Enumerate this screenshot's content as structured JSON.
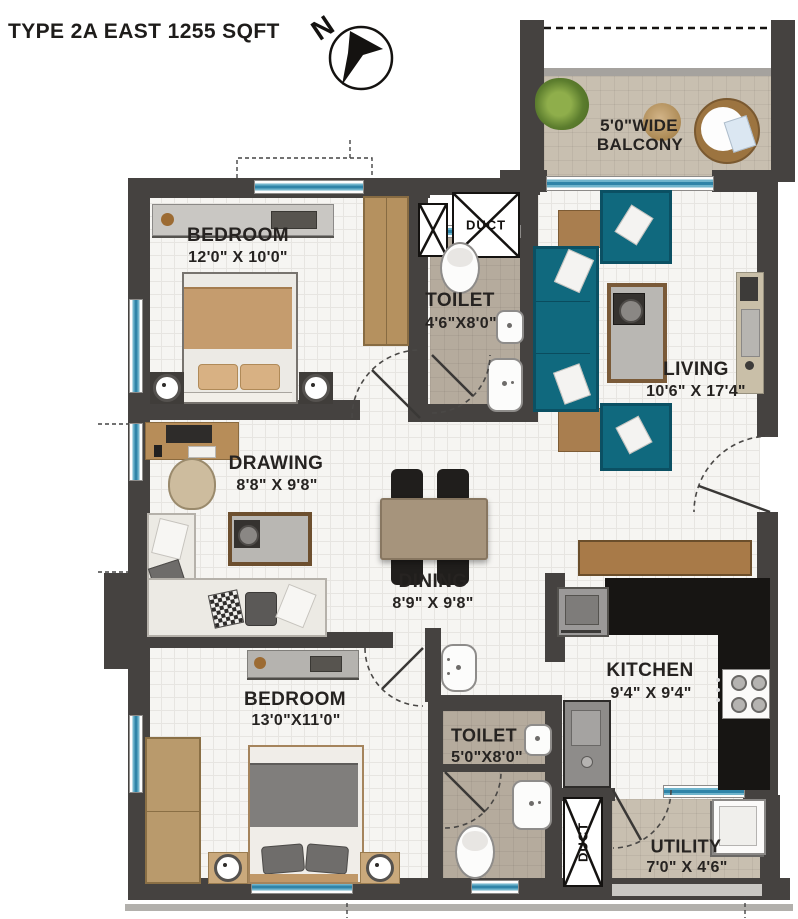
{
  "title": "TYPE 2A EAST 1255 SQFT",
  "compass": {
    "north_label": "N"
  },
  "rooms": {
    "balcony": {
      "label_line1": "5'0\"WIDE",
      "label_line2": "BALCONY"
    },
    "bedroom1": {
      "label": "BEDROOM",
      "dims": "12'0\" X 10'0\""
    },
    "toilet1": {
      "label": "TOILET",
      "dims": "4'6\"X8'0\""
    },
    "living": {
      "label": "LIVING",
      "dims": "10'6\" X 17'4\""
    },
    "drawing": {
      "label": "DRAWING",
      "dims": "8'8\" X 9'8\""
    },
    "dining": {
      "label": "DINING",
      "dims": "8'9\" X 9'8\""
    },
    "bedroom2": {
      "label": "BEDROOM",
      "dims": "13'0\"X11'0\""
    },
    "toilet2": {
      "label": "TOILET",
      "dims": "5'0\"X8'0\""
    },
    "kitchen": {
      "label": "KITCHEN",
      "dims": "9'4\" X 9'4\""
    },
    "utility": {
      "label": "UTILITY",
      "dims": "7'0\" X 4'6\""
    },
    "duct_top": {
      "label": "DUCT"
    },
    "duct_bottom": {
      "label": "DUCT"
    }
  },
  "colors": {
    "wall": "#454240",
    "window_teal": "#2f84a8",
    "sofa_teal": "#10697e",
    "wood_brown": "#a87a48",
    "bed_tan": "#c59c6e",
    "counter_black": "#171513",
    "balcony_floor": "#c8bfb0",
    "toilet_floor": "#b5ab9d",
    "text": "#262321"
  }
}
